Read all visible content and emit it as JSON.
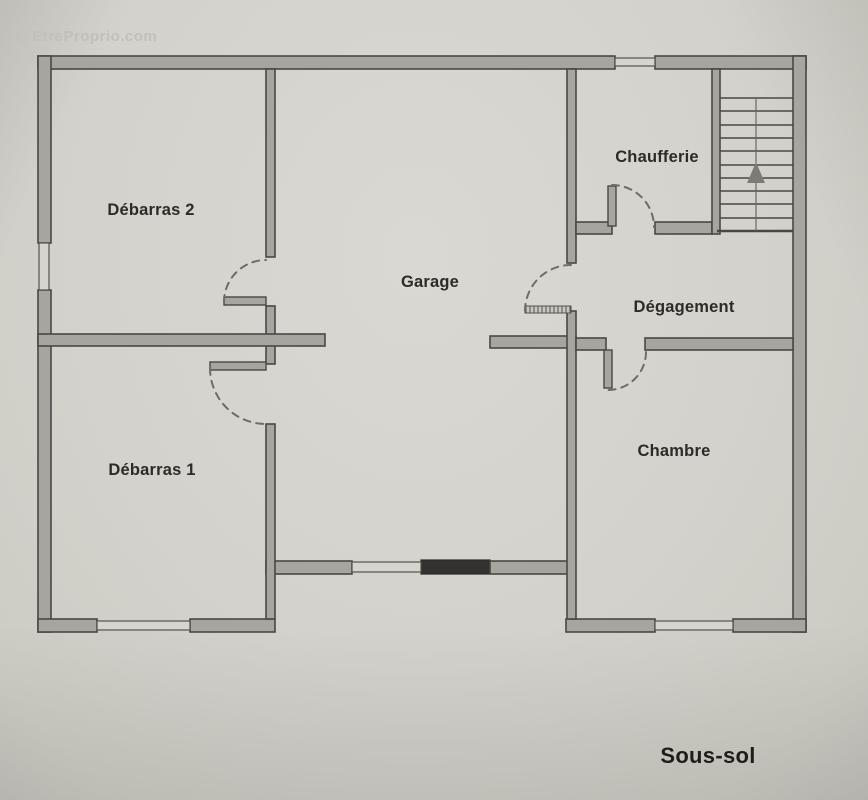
{
  "watermark": "© EtreProprio.com",
  "plan": {
    "floor_label": "Sous-sol",
    "rooms": [
      {
        "id": "debarras-2",
        "label": "Débarras 2"
      },
      {
        "id": "debarras-1",
        "label": "Débarras 1"
      },
      {
        "id": "garage",
        "label": "Garage"
      },
      {
        "id": "chaufferie",
        "label": "Chaufferie"
      },
      {
        "id": "degagement",
        "label": "Dégagement"
      },
      {
        "id": "chambre",
        "label": "Chambre"
      }
    ],
    "stairs": {
      "treads": 10,
      "direction_icon": "up-arrow"
    },
    "door_count": 5,
    "window_count": 5
  },
  "colors": {
    "paper": "#d4d2cc",
    "wall_fill": "#a7a5a0",
    "wall_line": "#4a4843",
    "dark_segment": "#343230",
    "door_arc": "#6e6c66",
    "label_text": "#2d2b27",
    "watermark": "#c2c0ba"
  }
}
